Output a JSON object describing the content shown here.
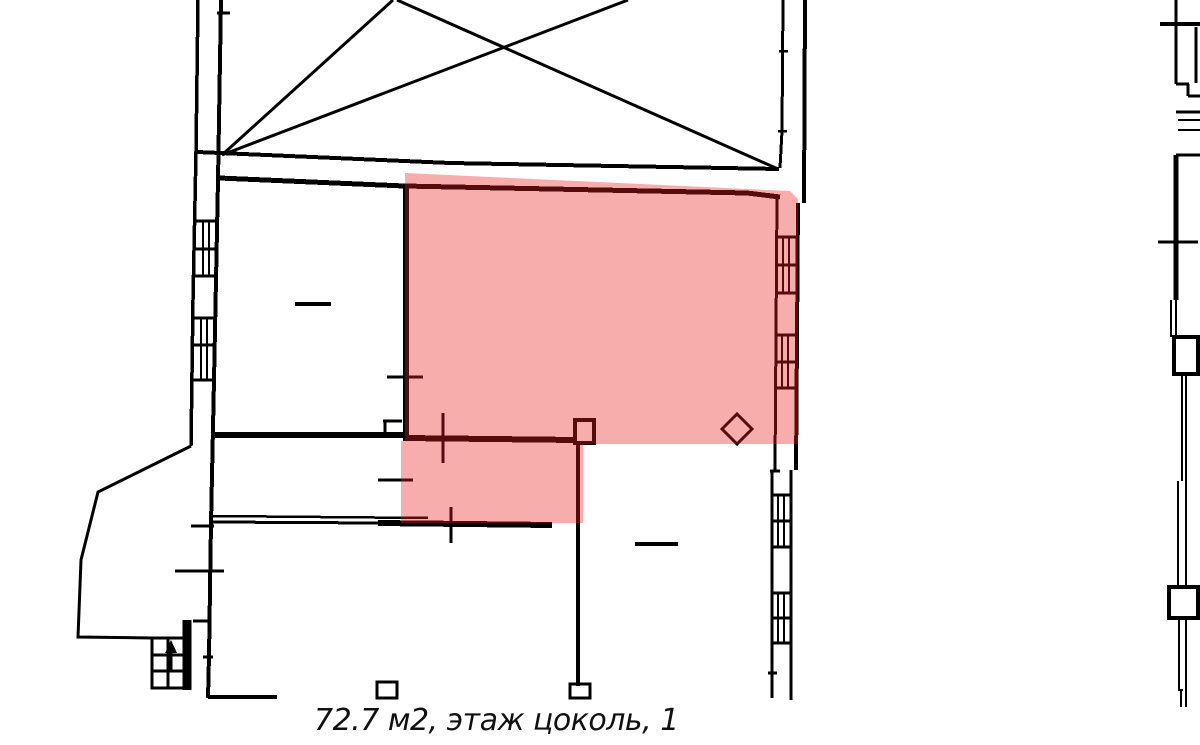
{
  "caption": {
    "text": "72.7 м2, этаж цоколь, 1",
    "area": "72.7 м2",
    "floor_label": "этаж цоколь, 1"
  },
  "colors": {
    "background": "#ffffff",
    "line": "#000000",
    "highlight": "#e6201f",
    "highlight_opacity": "0.37",
    "text": "#111111"
  }
}
